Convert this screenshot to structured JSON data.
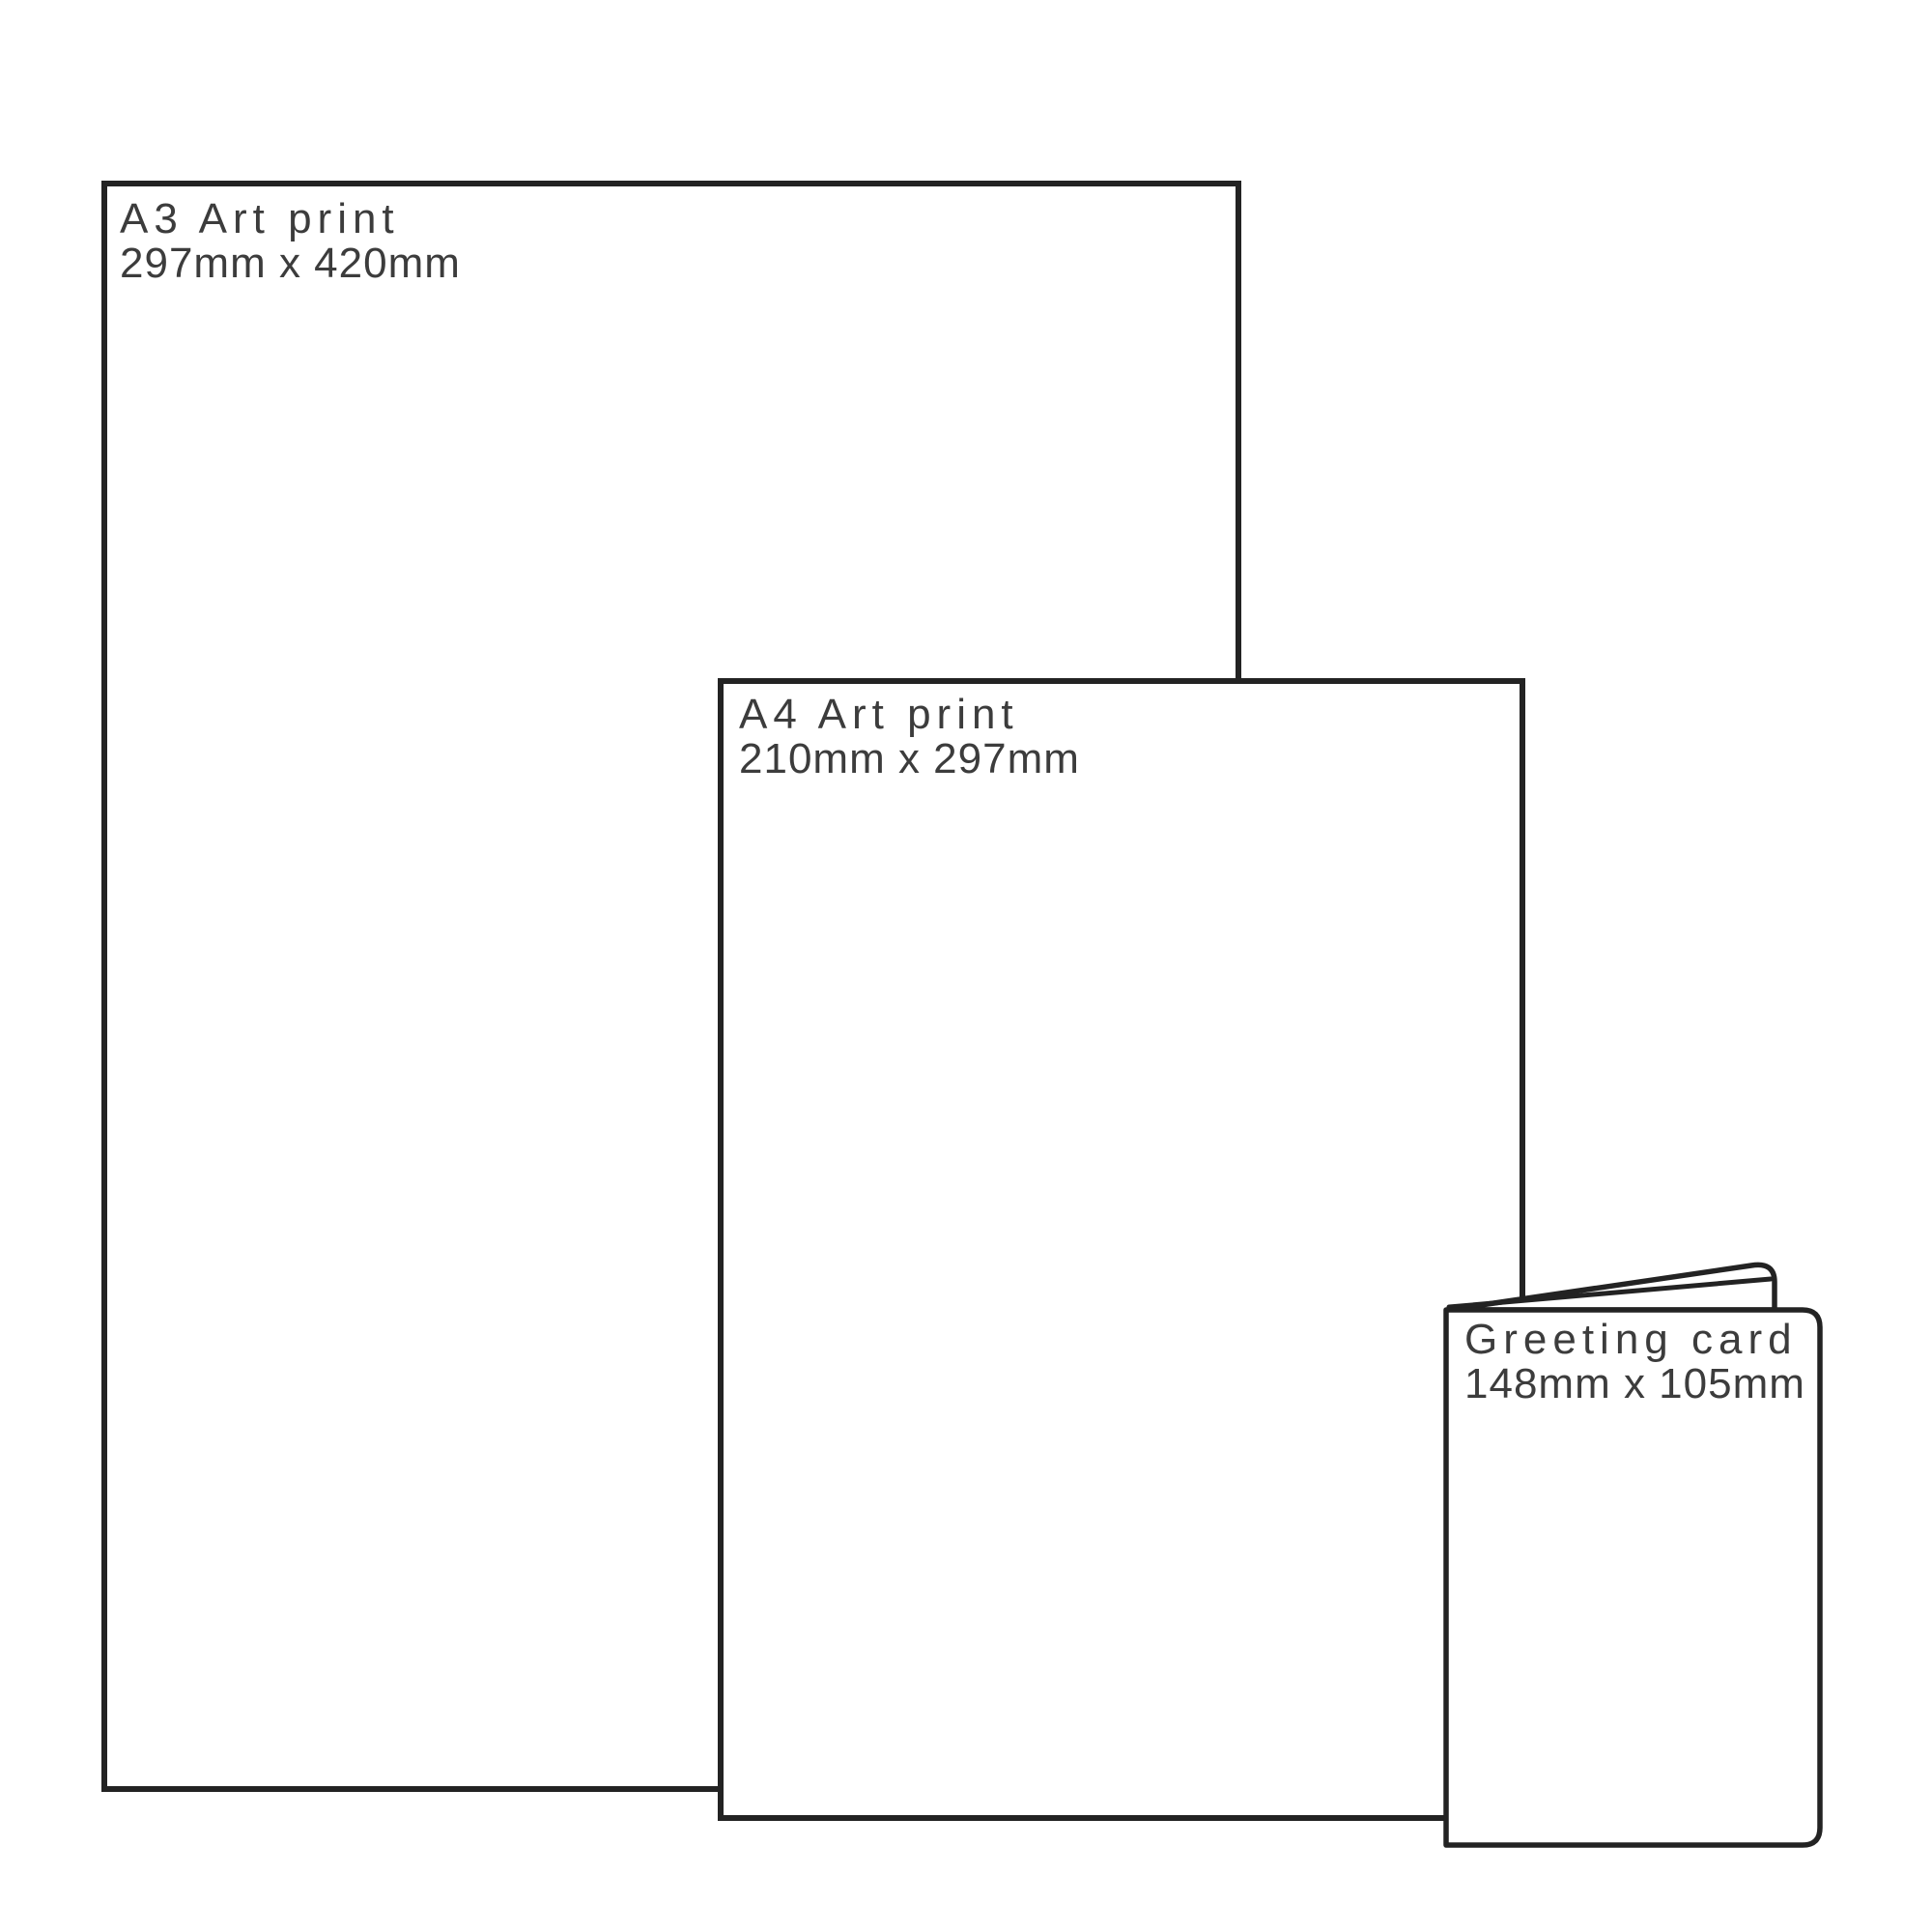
{
  "diagram": {
    "description": "Print product size comparison",
    "background_color": "#ffffff",
    "outline_color": "#232323",
    "text_color": "#3c3c3c"
  },
  "items": [
    {
      "id": "a3-art-print",
      "title": "A3 Art print",
      "dimensions": "297mm x 420mm"
    },
    {
      "id": "a4-art-print",
      "title": "A4 Art print",
      "dimensions": "210mm x 297mm"
    },
    {
      "id": "greeting-card",
      "title": "Greeting card",
      "dimensions": "148mm x 105mm"
    }
  ]
}
